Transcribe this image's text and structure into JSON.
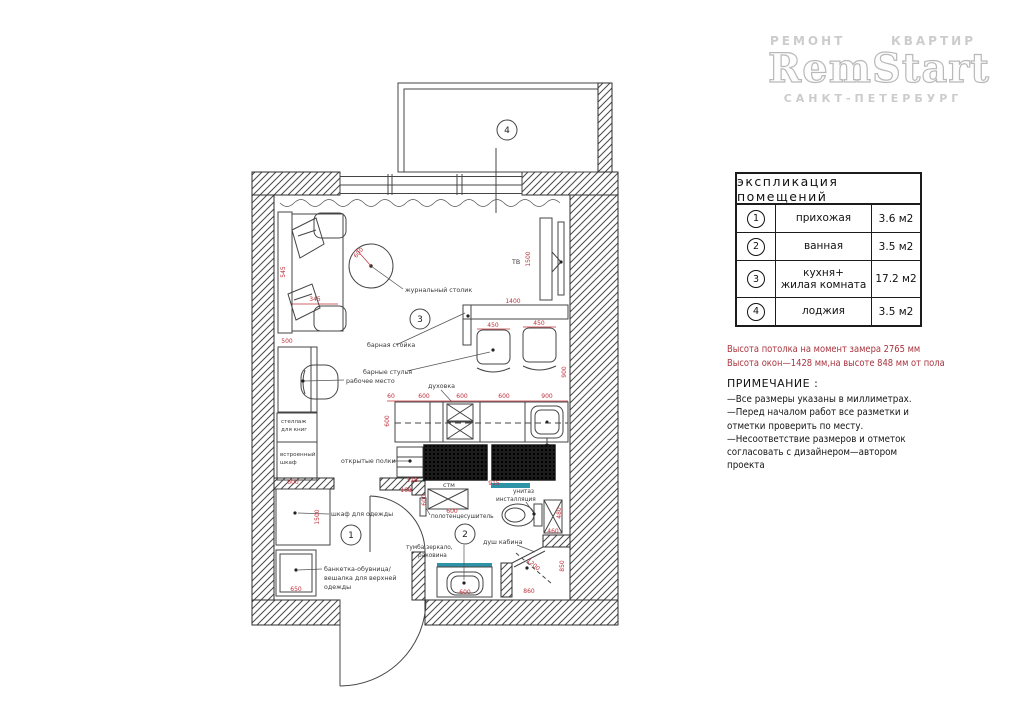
{
  "logo": {
    "tagline_left": "РЕМОНТ",
    "tagline_right": "КВАРТИР",
    "brand": "RemStart",
    "city": "САНКТ-ПЕТЕРБУРГ"
  },
  "legend": {
    "title": "экспликация помещений",
    "rows": [
      {
        "num": "1",
        "name": "прихожая",
        "area": "3.6 м2"
      },
      {
        "num": "2",
        "name": "ванная",
        "area": "3.5 м2"
      },
      {
        "num": "3",
        "name": "кухня+",
        "name2": "жилая комната",
        "area": "17.2 м2"
      },
      {
        "num": "4",
        "name": "лоджия",
        "area": "3.5 м2"
      }
    ]
  },
  "measurements": {
    "line1": "Высота потолка на момент замера 2765 мм",
    "line2": "Высота окон—1428 мм,на высоте 848 мм от пола"
  },
  "notes": {
    "title": "ПРИМЕЧАНИЕ :",
    "items": [
      "—Все размеры указаны в миллиметрах.",
      "—Перед началом работ все разметки и отметки проверить по месту.",
      "—Несоответствие размеров и отметок согласовать с дизайнером—автором проекта"
    ]
  },
  "plan": {
    "rooms": [
      {
        "num": "1"
      },
      {
        "num": "2"
      },
      {
        "num": "3"
      },
      {
        "num": "4"
      }
    ],
    "labels": [
      {
        "t": "журнальный столик"
      },
      {
        "t": "ТВ"
      },
      {
        "t": "барная стойка"
      },
      {
        "t": "барные стулья"
      },
      {
        "t": "рабочее место"
      },
      {
        "t": "духовка"
      },
      {
        "t": "открытые полки"
      },
      {
        "t": "стеллаж"
      },
      {
        "t": "для книг"
      },
      {
        "t": "встроенный"
      },
      {
        "t": "шкаф"
      },
      {
        "t": "шкаф для одежды"
      },
      {
        "t": "банкетка-обувница/"
      },
      {
        "t": "вешалка для верхней"
      },
      {
        "t": "одежды"
      },
      {
        "t": "стм"
      },
      {
        "t": "полотенцесушитель"
      },
      {
        "t": "унитаз"
      },
      {
        "t": "инсталляция"
      },
      {
        "t": "душ кабина"
      },
      {
        "t": "тумба,зеркало,"
      },
      {
        "t": "раковина"
      }
    ],
    "dims": [
      {
        "v": "600"
      },
      {
        "v": "545"
      },
      {
        "v": "345"
      },
      {
        "v": "500"
      },
      {
        "v": "1500"
      },
      {
        "v": "1400"
      },
      {
        "v": "450"
      },
      {
        "v": "450"
      },
      {
        "v": "900"
      },
      {
        "v": "60"
      },
      {
        "v": "600"
      },
      {
        "v": "600"
      },
      {
        "v": "600"
      },
      {
        "v": "900"
      },
      {
        "v": "600"
      },
      {
        "v": "318"
      },
      {
        "v": "168"
      },
      {
        "v": "915"
      },
      {
        "v": "600"
      },
      {
        "v": "600"
      },
      {
        "v": "460"
      },
      {
        "v": "480"
      },
      {
        "v": "600"
      },
      {
        "v": "1500"
      },
      {
        "v": "650"
      },
      {
        "v": "600"
      },
      {
        "v": "860"
      },
      {
        "v": "850"
      },
      {
        "v": "1200"
      }
    ]
  },
  "colors": {
    "dimension_red": "#c0303a",
    "note_red": "#a8343e",
    "accent_teal": "#2f93a8",
    "line": "#3a3a3a"
  }
}
